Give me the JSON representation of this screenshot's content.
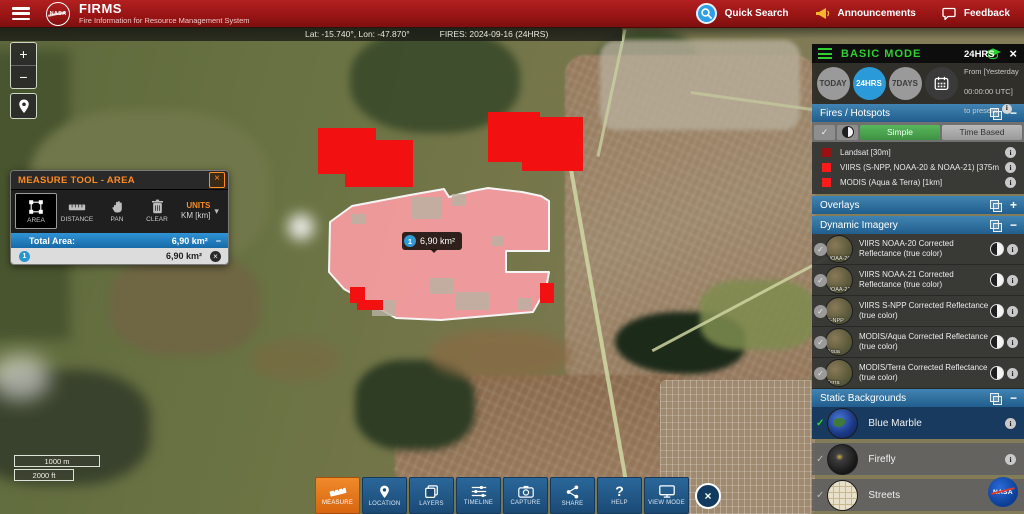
{
  "app": {
    "title": "FIRMS",
    "subtitle": "Fire Information for Resource Management System",
    "logo_text": "NASA"
  },
  "header": {
    "quick_search": "Quick Search",
    "announcements": "Announcements",
    "feedback": "Feedback"
  },
  "statusbar": {
    "coordinates": "Lat: -15.740°, Lon: -47.870°",
    "fires_date": "FIRES: 2024-09-16 (24HRS)"
  },
  "map_controls": {
    "zoom_in": "+",
    "zoom_out": "−",
    "scale_metric": "1000 m",
    "scale_imperial": "2000 ft"
  },
  "map_tooltip": {
    "index": "1",
    "value": "6,90 km²"
  },
  "measure_panel": {
    "title": "MEASURE TOOL - AREA",
    "tools": [
      {
        "label": "AREA"
      },
      {
        "label": "DISTANCE"
      },
      {
        "label": "PAN"
      },
      {
        "label": "CLEAR"
      }
    ],
    "units_label": "UNITS",
    "units_value": "KM [km]",
    "total_label": "Total Area:",
    "total_value": "6,90 km²",
    "entry": {
      "index": "1",
      "value": "6,90 km²"
    }
  },
  "sidebar": {
    "mode_title": "BASIC MODE",
    "date_buttons": [
      {
        "label": "TODAY"
      },
      {
        "label": "24HRS"
      },
      {
        "label": "7DAYS"
      }
    ],
    "range_title": "24HRS",
    "range_description": "From [Yesterday 00:00:00 UTC] to present",
    "fires": {
      "title": "Fires / Hotspots",
      "simple": "Simple",
      "time_based": "Time Based",
      "items": [
        {
          "label": "Landsat [30m]",
          "color": "#9a1111"
        },
        {
          "label": "VIIRS (S-NPP, NOAA-20 & NOAA-21) [375m]",
          "color": "#ff1a1a"
        },
        {
          "label": "MODIS (Aqua & Terra) [1km]",
          "color": "#ff1a1a"
        }
      ]
    },
    "overlays": {
      "title": "Overlays"
    },
    "dynamic_imagery": {
      "title": "Dynamic Imagery",
      "items": [
        {
          "label": "VIIRS NOAA-20 Corrected Reflectance (true color)",
          "thumb": "NOAA-20"
        },
        {
          "label": "VIIRS NOAA-21 Corrected Reflectance (true color)",
          "thumb": "NOAA-21"
        },
        {
          "label": "VIIRS S-NPP Corrected Reflectance (true color)",
          "thumb": "S-NPP"
        },
        {
          "label": "MODIS/Aqua Corrected Reflectance (true color)",
          "thumb": "Aqua"
        },
        {
          "label": "MODIS/Terra Corrected Reflectance (true color)",
          "thumb": "Terra"
        }
      ]
    },
    "static_backgrounds": {
      "title": "Static Backgrounds",
      "items": [
        {
          "label": "Blue Marble"
        },
        {
          "label": "Firefly"
        },
        {
          "label": "Streets"
        }
      ]
    }
  },
  "toolbar": {
    "buttons": [
      {
        "label": "MEASURE"
      },
      {
        "label": "LOCATION"
      },
      {
        "label": "LAYERS"
      },
      {
        "label": "TIMELINE"
      },
      {
        "label": "CAPTURE"
      },
      {
        "label": "SHARE"
      },
      {
        "label": "HELP"
      },
      {
        "label": "VIEW MODE"
      }
    ]
  },
  "colors": {
    "header_red": "#971414",
    "accent_orange": "#e8731f",
    "section_header_blue": "#2e6e9e",
    "selected_blue": "#2a9bd8",
    "simple_green": "#43a047",
    "basic_mode_green": "#2fd02f",
    "fire_red": "#ff1a1a",
    "landsat_red": "#9a1111",
    "measure_pink": "#ff9ea6"
  }
}
